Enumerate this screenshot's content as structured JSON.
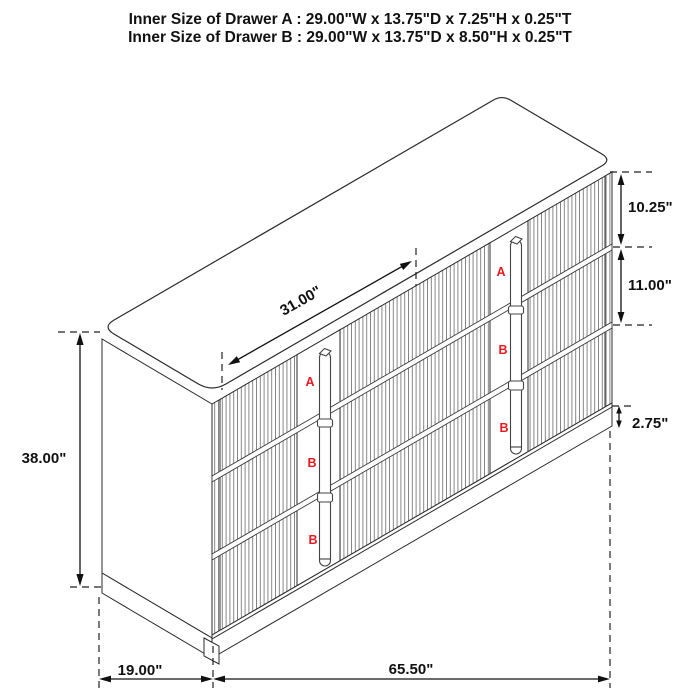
{
  "title": {
    "line_a": "Inner Size of Drawer A : 29.00\"W x 13.75\"D x 7.25\"H x 0.25\"T",
    "line_b": "Inner Size of Drawer B : 29.00\"W x 13.75\"D x 8.50\"H x 0.25\"T"
  },
  "dimensions": {
    "top_diagonal": "31.00\"",
    "overall_height": "38.00\"",
    "drawer_a_height": "10.25\"",
    "drawer_b_height": "11.00\"",
    "base_height": "2.75\"",
    "depth": "19.00\"",
    "overall_width": "65.50\""
  },
  "drawers": {
    "left": [
      "A",
      "B",
      "B"
    ],
    "right": [
      "A",
      "B",
      "B"
    ]
  },
  "colors": {
    "label_red": "#e8191f",
    "line": "#2b2b2b",
    "flute": "#7a7a7a",
    "background": "#ffffff"
  }
}
